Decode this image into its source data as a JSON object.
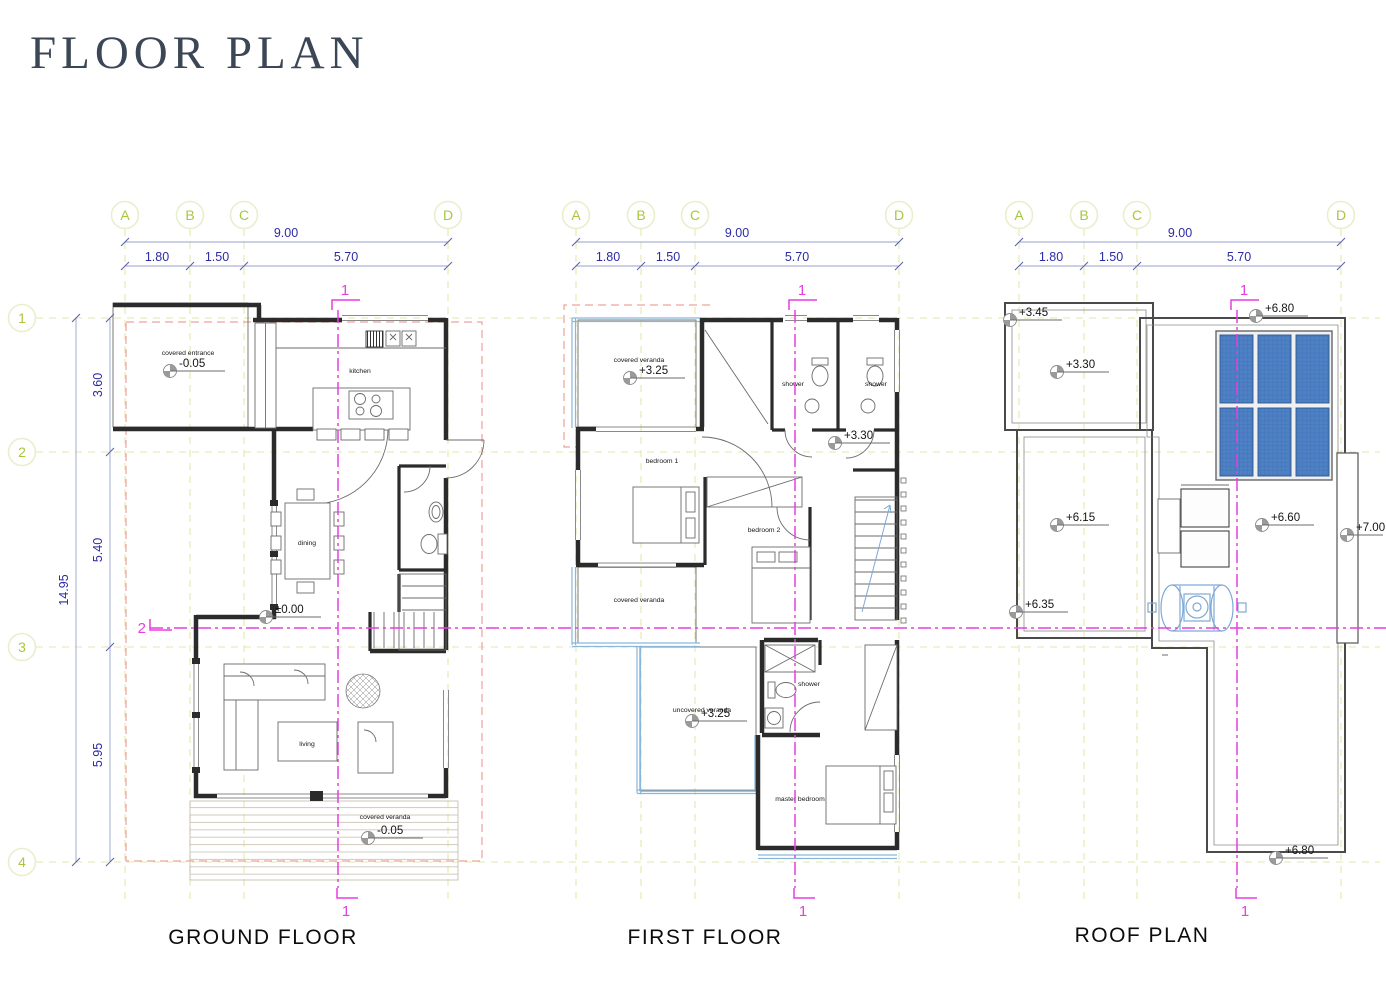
{
  "page": {
    "title": "FLOOR PLAN"
  },
  "grid": {
    "columns": [
      "A",
      "B",
      "C",
      "D"
    ],
    "rows": [
      "1",
      "2",
      "3",
      "4"
    ],
    "top_total": "9.00",
    "top_segments": [
      "1.80",
      "1.50",
      "5.70"
    ],
    "side_total": "14.95",
    "side_segments": [
      "3.60",
      "5.40",
      "5.95"
    ]
  },
  "sections": {
    "one": "1",
    "two": "2"
  },
  "plans": {
    "ground": {
      "title": "GROUND FLOOR",
      "rooms": {
        "covered_entrance": "covered entrance",
        "kitchen": "kitchen",
        "dining": "dining",
        "living": "living",
        "covered_veranda": "covered veranda"
      },
      "levels": {
        "entrance": "-0.05",
        "main": "±0.00",
        "veranda": "-0.05"
      }
    },
    "first": {
      "title": "FIRST FLOOR",
      "rooms": {
        "covered_veranda_top": "covered veranda",
        "shower_left": "shower",
        "shower_right": "shower",
        "bedroom1": "bedroom 1",
        "bedroom2": "bedroom 2",
        "covered_veranda_mid": "covered veranda",
        "uncovered_veranda": "uncovered veranda",
        "shower_bottom": "shower",
        "master_bedroom": "master bedroom"
      },
      "levels": {
        "veranda_top": "+3.25",
        "hall": "+3.30",
        "uncovered_veranda": "+3.25"
      }
    },
    "roof": {
      "title": "ROOF PLAN",
      "levels": {
        "entrance_high": "+3.45",
        "entrance": "+3.30",
        "parapet_top": "+6.80",
        "low_roof": "+6.15",
        "low_roof_edge": "+6.35",
        "main_roof": "+6.60",
        "parapet_side": "+7.00",
        "parapet_bottom": "+6.80"
      }
    }
  },
  "colors": {
    "title": "#3b4656",
    "grid_bubble": "#a7c83e",
    "dimension_text": "#2b2ba6",
    "section_magenta": "#e73ee0",
    "roof_overhang_red": "#efa29a",
    "veranda_blue": "#8ab6da",
    "solar_panel_blue": "#4d80c4",
    "walls": "#2b2b2b"
  }
}
